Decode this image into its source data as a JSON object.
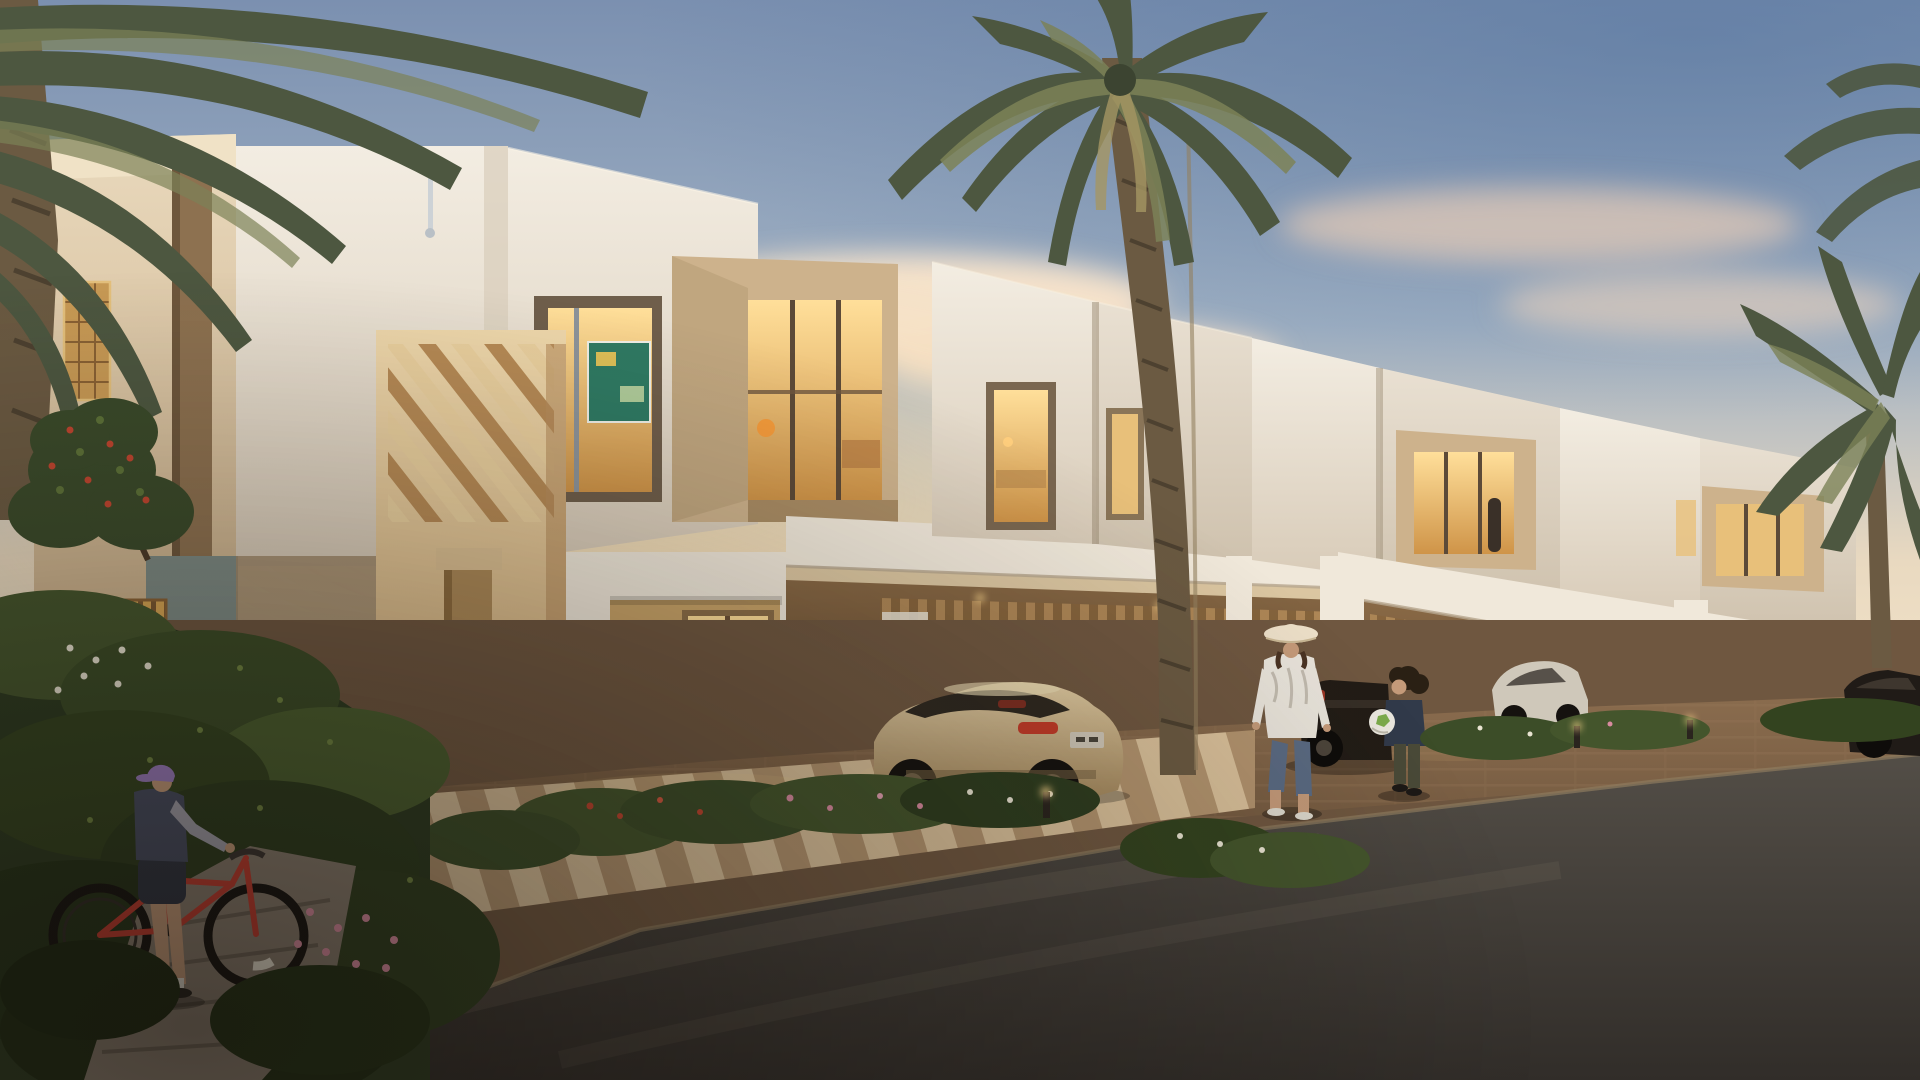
{
  "meta": {
    "type": "architectural-rendering",
    "description": "Photorealistic dusk rendering of a row of modern flat-roofed townhouses with lit windows, carports with parked cars, date palms, flower gardens, a woman walking, a child holding a ball and a boy with a red bicycle",
    "time_of_day": "dusk"
  },
  "palette": {
    "sky_top": "#7b90b0",
    "sky_mid": "#9fb0c3",
    "sky_warm": "#e9d9c0",
    "sky_horizon": "#f7e8cd",
    "glow_warm": "#ffe3ae",
    "cloud_cream": "#f2d8bd",
    "wall_white": "#f3ede2",
    "wall_white_shade": "#d8cbb8",
    "tower_top": "#e9d9bd",
    "tower_bottom": "#c6a981",
    "portal_light": "#eed7ab",
    "portal_dark": "#cfa975",
    "box_frame": "#cdb28c",
    "recess_brown": "#6f5e4b",
    "window_glow_top": "#ffdf9a",
    "window_glow_bottom": "#cf9448",
    "window_dim": "#e8c07a",
    "canopy_white": "#f0e8da",
    "canopy_shade": "#d8cab6",
    "carport_light": "#8a6a46",
    "carport_dark": "#5f472f",
    "slat_light": "#b28a58",
    "slat_dark": "#86643c",
    "fence_wood": "#d8a653",
    "fence_gap": "#7a5730",
    "wood_screen": "#c89a55",
    "teal_wall": "#7e8b85",
    "drive_light": "#8a6c4e",
    "drive_dark": "#5c4631",
    "paver_light": "#d9c09a",
    "paver_dark": "#b2936e",
    "asphalt_light": "#534e47",
    "asphalt_dark": "#312d29",
    "stone_path": "#877b6d",
    "garden_dark": "#2c3a20",
    "garden_mid": "#44552c",
    "garden_light": "#6f8440",
    "flower_pink": "#d98ba0",
    "flower_white": "#e9e4d2",
    "flower_red": "#c0452f",
    "palm_green": "#4d5740",
    "palm_green_light": "#7c8257",
    "palm_trunk": "#6b5a42",
    "car_champagne_light": "#e0cba2",
    "car_champagne_dark": "#a3875c",
    "car_glass": "#2e2820",
    "taillight_red": "#c23b28",
    "plate_gray": "#cfc7b8",
    "car_dark": "#221c16",
    "car_silver": "#cfc8ba",
    "bike_red": "#c23b2e",
    "cap_purple": "#9b7cbf",
    "ball_white": "#eae7de",
    "ball_green": "#7cab4c",
    "hat_cream": "#ecdfc8",
    "hoodie_white": "#e8e3da",
    "jeans_blue": "#5a6a82",
    "skin": "#c49a79",
    "hair_dark": "#2a2014",
    "bollard_glow": "#ffd98e"
  },
  "scene": {
    "objects": [
      {
        "name": "townhouse-row",
        "note": "four modern beige-and-white townhouses receding to the right"
      },
      {
        "name": "date-palm-center",
        "note": "tall palm in front of second house"
      },
      {
        "name": "date-palm-left",
        "note": "palm fronds sweeping in from top-left corner"
      },
      {
        "name": "date-palm-right",
        "note": "palm crown at right edge"
      },
      {
        "name": "champagne-coupe",
        "note": "champagne sports coupe parked in first carport"
      },
      {
        "name": "dark-pickup",
        "note": "dark pickup behind woman and child"
      },
      {
        "name": "silver-car",
        "note": "silver car in third carport"
      },
      {
        "name": "woman-with-sun-hat",
        "note": "walking on driveway"
      },
      {
        "name": "child-with-ball",
        "note": "facing woman, holding white-green ball"
      },
      {
        "name": "boy-with-red-bicycle",
        "note": "foreground left on stone path"
      },
      {
        "name": "lit-windows",
        "note": "warm interior lighting throughout"
      },
      {
        "name": "wooden-screen-fence",
        "note": "backlit slatted fence at left"
      },
      {
        "name": "flower-gardens",
        "note": "beds with pink, white and red flowers"
      },
      {
        "name": "paver-walkway",
        "note": "striped pavers in front of entrance"
      },
      {
        "name": "brick-driveway",
        "note": "warm brick paving"
      },
      {
        "name": "asphalt-road",
        "note": "dark road in foreground"
      },
      {
        "name": "bollard-lights",
        "note": "small glowing path lights"
      }
    ]
  }
}
